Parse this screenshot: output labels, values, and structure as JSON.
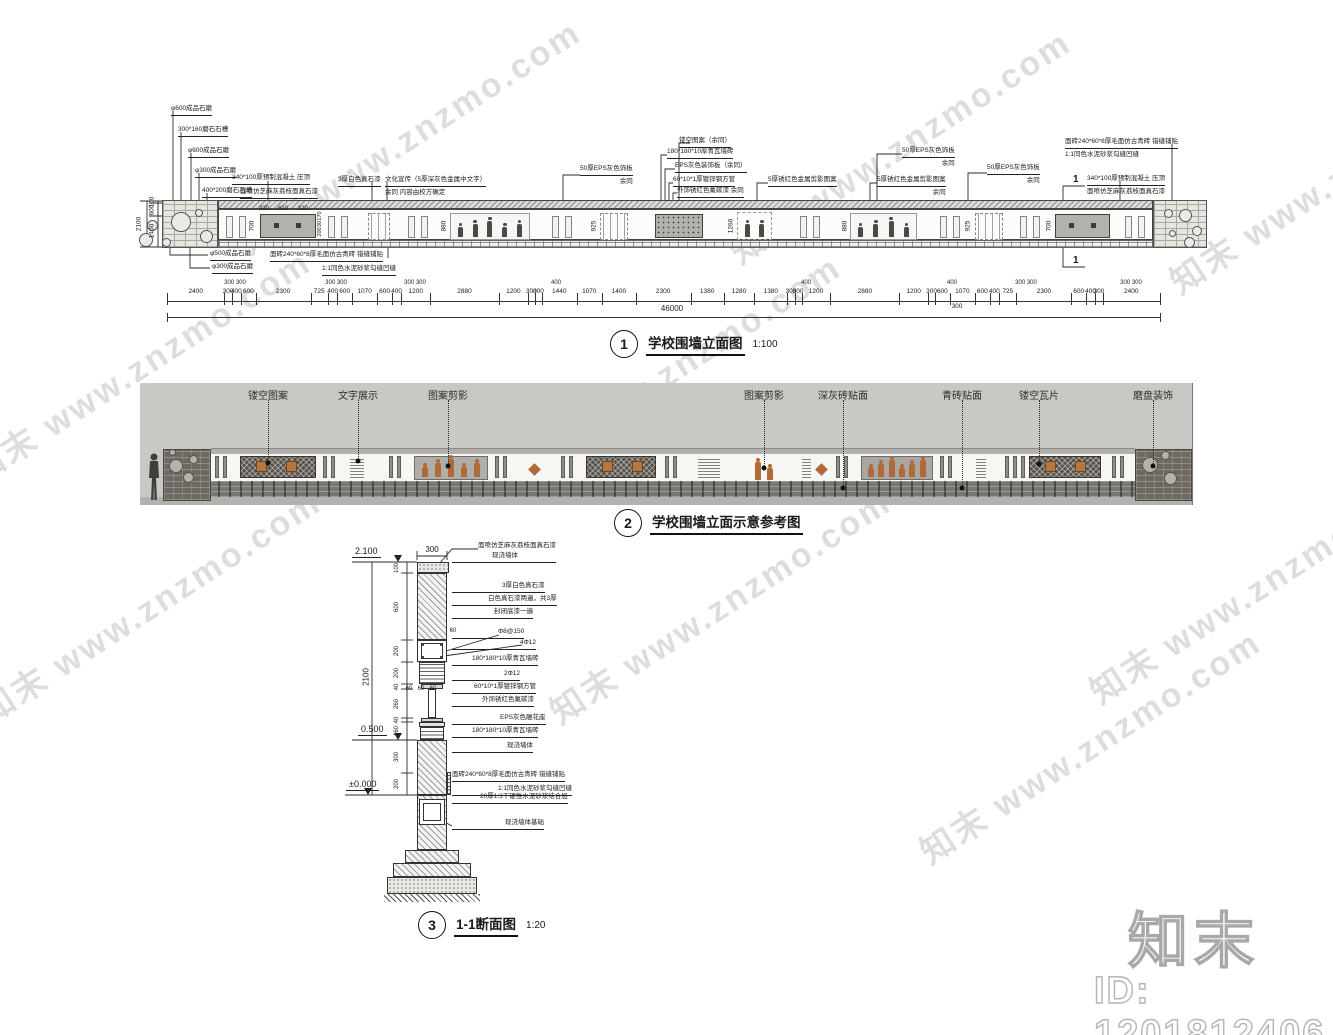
{
  "watermark": {
    "text": "知末 www.znzmo.com"
  },
  "footer": {
    "logo": "知末",
    "id": "ID: 1201812406"
  },
  "colors": {
    "line": "#222222",
    "panel_grey": "#b3b1ad",
    "accent_orange": "#b5763f",
    "ref_background": "#c9c8c4",
    "pier_dark": "#6e6a63",
    "watermark_grey": "#c8c8c8"
  },
  "elevation": {
    "number": "1",
    "title": "学校围墙立面图",
    "scale": "1:100",
    "section_marker": "1",
    "callouts_left": [
      "φ600成品石磨",
      "300*160磨石石槽",
      "φ600成品石磨",
      "φ300成品石磨",
      "400*200磨石石槽",
      "340*100厚预制混凝土 压顶",
      "面喷仿芝麻灰荔枝面真石漆"
    ],
    "callouts_bottom": [
      "φ500成品石磨",
      "φ300成品石磨",
      "面砖240*60*8厚毛面仿古青砖 错缝铺贴",
      "1:1同色水泥砂浆勾缝凹缝"
    ],
    "callouts_top": [
      {
        "lines": [
          "3厚白色真石漆"
        ]
      },
      {
        "lines": [
          "文化宣传（5厚深灰色金属中文字）",
          "余同 内容由校方确定"
        ]
      },
      {
        "lines": [
          "50厚EPS灰色饰板",
          "余同"
        ]
      },
      {
        "lines": [
          "镂空图案（余同）"
        ]
      },
      {
        "lines": [
          "180*180*10厚青瓦墙砖"
        ]
      },
      {
        "lines": [
          "EPS灰色装饰板（余同）"
        ]
      },
      {
        "lines": [
          "60*10*1厚镀锌钢方管"
        ]
      },
      {
        "lines": [
          "外饰锈红色氟碳漆 余同"
        ]
      },
      {
        "lines": [
          "5厚锈红色金属剪影图案"
        ]
      },
      {
        "lines": [
          "50厚EPS灰色饰板",
          "余同"
        ]
      },
      {
        "lines": [
          "5厚锈红色金属剪影图案",
          "余同"
        ]
      },
      {
        "lines": [
          "50厚EPS灰色饰板",
          "余同"
        ]
      },
      {
        "lines": [
          "面砖240*60*8厚毛面仿古青砖 错缝铺贴",
          "1:1同色水泥砂浆勾缝凹缝"
        ]
      },
      {
        "lines": [
          "340*100厚预制混凝土 压顶",
          "面喷仿芝麻灰荔枝面真石漆"
        ]
      }
    ],
    "dims_left": [
      "100",
      "600",
      "1400"
    ],
    "dims_left_total": "2100",
    "panel_dims": {
      "grey_top": [
        "320",
        "610",
        "320"
      ],
      "grey_side": [
        "170",
        "30",
        "200"
      ],
      "heights": [
        "700",
        "880",
        "925",
        "1266",
        "880",
        "925",
        "700"
      ]
    },
    "dims_bottom": [
      "2400",
      "300",
      "400",
      "600",
      "2300",
      "725",
      "400",
      "600",
      "1070",
      "600",
      "400",
      "1200",
      "2880",
      "1200",
      "300",
      "300",
      "1440",
      "1070",
      "1400",
      "2300",
      "1380",
      "1280",
      "1380",
      "300",
      "300",
      "1200",
      "2880",
      "1200",
      "300",
      "600",
      "1070",
      "600",
      "400",
      "725",
      "2300",
      "600",
      "400",
      "300",
      "2400"
    ],
    "dims_bottom_above": [
      "300 300",
      "300 300",
      "300 300",
      "400",
      "400",
      "400",
      "300 300",
      "300 300"
    ],
    "dims_bottom_below": "300",
    "dims_total": "46000"
  },
  "reference": {
    "number": "2",
    "title": "学校围墙立面示意参考图",
    "labels": [
      "镂空图案",
      "文字展示",
      "图案剪影",
      "图案剪影",
      "深灰砖贴面",
      "青砖贴面",
      "镂空瓦片",
      "磨盘装饰"
    ]
  },
  "section": {
    "number": "3",
    "title": "1-1断面图",
    "scale": "1:20",
    "levels": [
      "2.100",
      "0.500",
      "±0.000"
    ],
    "dim_top": "300",
    "dim_total": "2100",
    "dims_left": [
      "100",
      "600",
      "200",
      "200",
      "40",
      "260",
      "40",
      "160",
      "300",
      "200"
    ],
    "dims_small": [
      "60",
      "60",
      "60",
      "60"
    ],
    "labels": [
      {
        "lines": [
          "面喷仿芝麻灰荔枝面真石漆",
          "现浇墙体"
        ]
      },
      {
        "lines": [
          "3厚白色真石漆"
        ]
      },
      {
        "lines": [
          "白色真石漆两遍，共3厚"
        ]
      },
      {
        "lines": [
          "封闭底漆一遍"
        ]
      },
      {
        "lines": [
          "Φ8@150"
        ]
      },
      {
        "lines": [
          "4Φ12"
        ]
      },
      {
        "lines": [
          "180*180*10厚青瓦墙砖"
        ]
      },
      {
        "lines": [
          "2Φ12"
        ]
      },
      {
        "lines": [
          "60*10*1厚镀锌钢方管"
        ]
      },
      {
        "lines": [
          "外饰锈红色氟碳漆"
        ]
      },
      {
        "lines": [
          "EPS灰色雕花座"
        ]
      },
      {
        "lines": [
          "180*180*10厚青瓦墙砖"
        ]
      },
      {
        "lines": [
          "现浇墙体"
        ]
      },
      {
        "lines": [
          "面砖240*60*8厚毛面仿古青砖 错缝铺贴"
        ]
      },
      {
        "lines": [
          "1:1同色水泥砂浆勾缝凹缝"
        ]
      },
      {
        "lines": [
          "20厚1:3干硬性水泥砂浆结合层"
        ]
      },
      {
        "lines": [
          "现浇墙体基础"
        ]
      }
    ]
  }
}
